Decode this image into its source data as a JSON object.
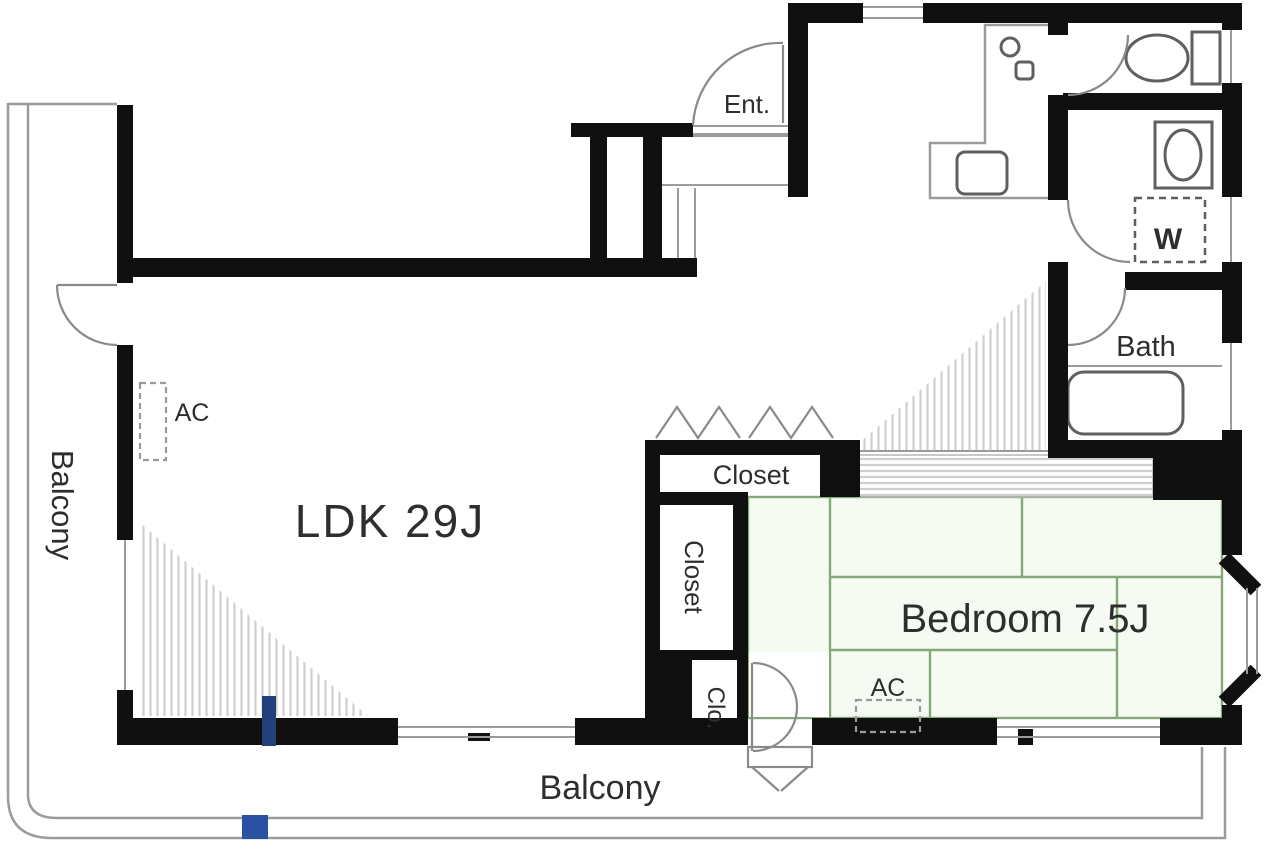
{
  "plan_type": "apartment-floor-plan",
  "labels": {
    "entrance": "Ent.",
    "washer": "W",
    "bath": "Bath",
    "closet_top": "Closet",
    "closet_side": "Closet",
    "closet_small": "Clo.",
    "ldk": "LDK 29J",
    "bedroom": "Bedroom 7.5J",
    "ac_ldk": "AC",
    "ac_bedroom": "AC",
    "balcony_left": "Balcony",
    "balcony_bottom": "Balcony"
  },
  "colors": {
    "wall": "#101010",
    "thin_line": "#9b9b9b",
    "hatch_line": "#cfcfcf",
    "tatami_line": "#86a878",
    "tatami_fill": "#f5faf2",
    "text": "#2e2e2e",
    "marker_blue_square": "#2b51a3",
    "marker_blue_tick": "#23407c",
    "background": "#ffffff"
  }
}
